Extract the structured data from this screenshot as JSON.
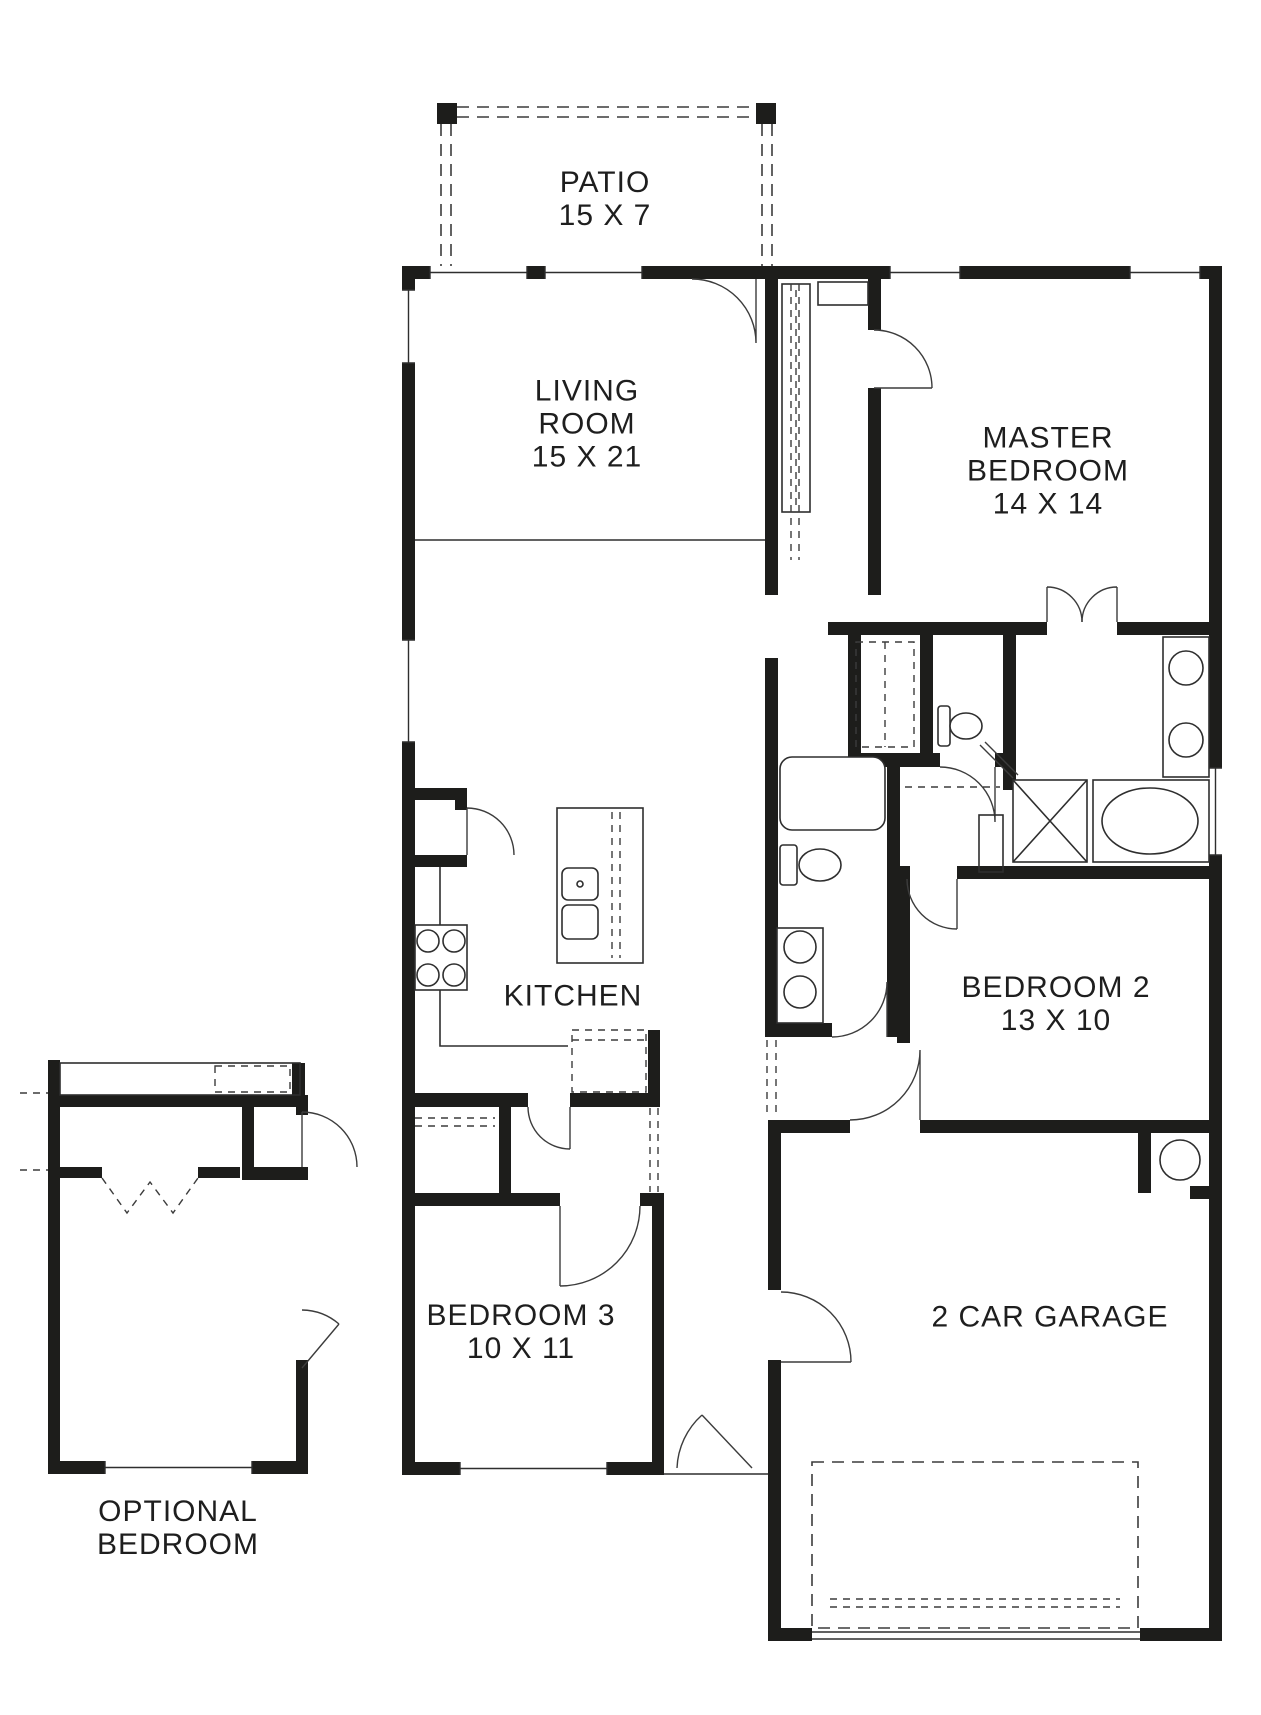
{
  "rooms": {
    "patio": {
      "name": "PATIO",
      "dims": "15 X 7"
    },
    "living_room": {
      "name_line1": "LIVING",
      "name_line2": "ROOM",
      "dims": "15 X 21"
    },
    "master_bedroom": {
      "name_line1": "MASTER",
      "name_line2": "BEDROOM",
      "dims": "14 X 14"
    },
    "kitchen": {
      "name": "KITCHEN"
    },
    "bedroom_2": {
      "name": "BEDROOM 2",
      "dims": "13 X 10"
    },
    "bedroom_3": {
      "name": "BEDROOM 3",
      "dims": "10 X 11"
    },
    "garage": {
      "name": "2 CAR GARAGE"
    },
    "optional_bedroom": {
      "name_line1": "OPTIONAL",
      "name_line2": "BEDROOM"
    }
  },
  "colors": {
    "wall": "#1d1d1b",
    "line": "#3c3c3c",
    "text": "#1e1e1e",
    "background": "#ffffff"
  }
}
